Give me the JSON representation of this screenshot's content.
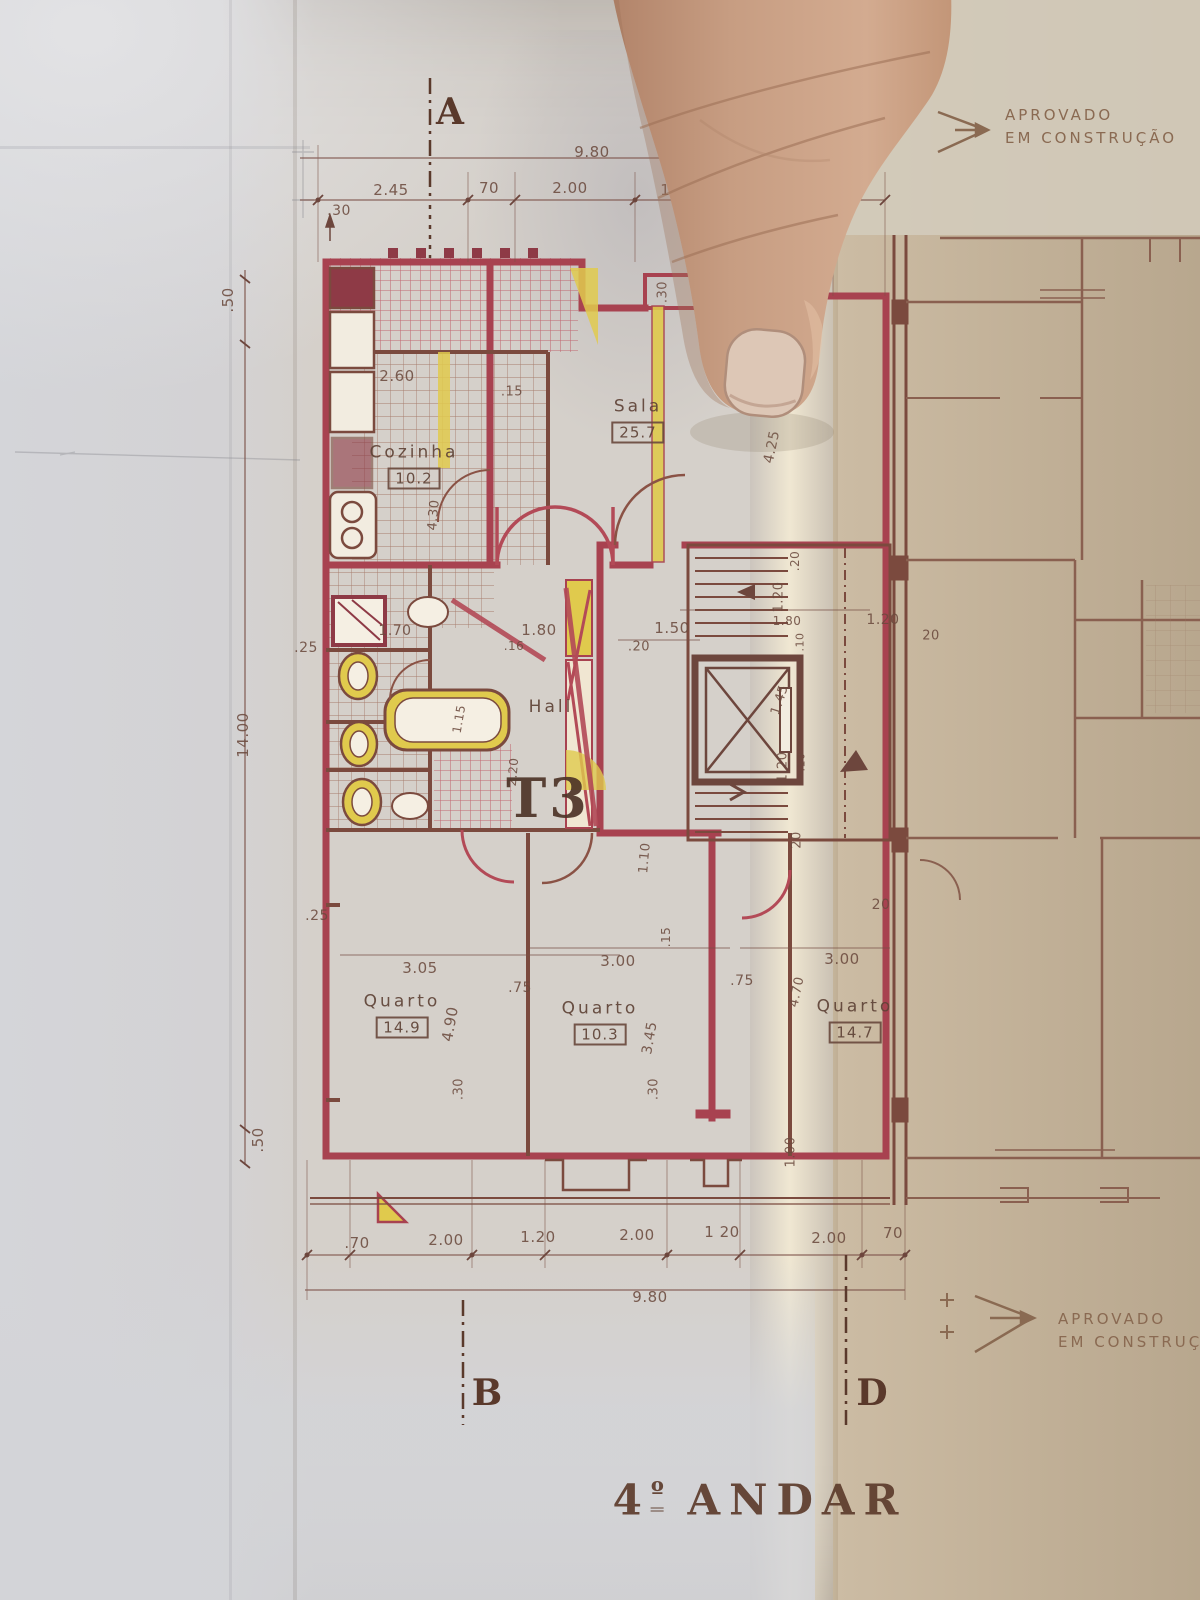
{
  "plan": {
    "floor_title": {
      "number": "4",
      "ordinal": "º",
      "word": "ANDAR"
    },
    "unit_type": "T3",
    "approval_top": {
      "line1": "APROVADO",
      "line2": "EM CONSTRUÇÃO"
    },
    "approval_bottom": {
      "line1": "APROVADO",
      "line2": "EM CONSTRUÇÃ"
    },
    "sections": {
      "a": "A",
      "b": "B",
      "d": "D"
    },
    "rooms": {
      "cozinha": {
        "name": "Cozinha",
        "area": "10.2"
      },
      "sala": {
        "name": "Sala",
        "area": "25.7"
      },
      "hall": {
        "name": "Hall"
      },
      "quarto1": {
        "name": "Quarto",
        "area": "14.9"
      },
      "quarto2": {
        "name": "Quarto",
        "area": "10.3"
      },
      "quarto3": {
        "name": "Quarto",
        "area": "14.7"
      }
    }
  },
  "dimension_labels": [
    {
      "t": "9.80",
      "x": 592,
      "y": 152
    },
    {
      "t": ".30",
      "x": 339,
      "y": 211,
      "fs": 14
    },
    {
      "t": "2.45",
      "x": 391,
      "y": 190
    },
    {
      "t": "70",
      "x": 489,
      "y": 188
    },
    {
      "t": "2.00",
      "x": 570,
      "y": 188
    },
    {
      "t": "1.50",
      "x": 678,
      "y": 190
    },
    {
      "t": "85",
      "x": 849,
      "y": 189
    },
    {
      "t": ".50",
      "x": 228,
      "y": 300,
      "r": -90
    },
    {
      "t": "14.00",
      "x": 243,
      "y": 735,
      "r": -90
    },
    {
      "t": ".25",
      "x": 306,
      "y": 648,
      "fs": 14
    },
    {
      "t": ".25",
      "x": 317,
      "y": 916,
      "fs": 14
    },
    {
      "t": ".50",
      "x": 258,
      "y": 1140,
      "r": -90
    },
    {
      "t": "2.60",
      "x": 397,
      "y": 376
    },
    {
      "t": ".15",
      "x": 512,
      "y": 392,
      "fs": 13
    },
    {
      "t": "6.6",
      "x": 716,
      "y": 370,
      "fs": 14
    },
    {
      "t": ".30",
      "x": 663,
      "y": 292,
      "r": -90,
      "fs": 13
    },
    {
      "t": "4.25",
      "x": 772,
      "y": 447,
      "r": -78,
      "fs": 14
    },
    {
      "t": "4.30",
      "x": 434,
      "y": 515,
      "r": -85,
      "fs": 13
    },
    {
      "t": "1.70",
      "x": 395,
      "y": 631,
      "fs": 14
    },
    {
      "t": "1.80",
      "x": 539,
      "y": 630
    },
    {
      "t": ".16",
      "x": 514,
      "y": 646,
      "fs": 12
    },
    {
      "t": "1.50",
      "x": 672,
      "y": 628
    },
    {
      "t": ".20",
      "x": 639,
      "y": 647,
      "fs": 13
    },
    {
      "t": "1.15",
      "x": 459,
      "y": 719,
      "r": -80,
      "fs": 12
    },
    {
      "t": "2.20",
      "x": 513,
      "y": 772,
      "r": -85,
      "fs": 12
    },
    {
      "t": "1.20",
      "x": 779,
      "y": 597,
      "r": -90,
      "fs": 13
    },
    {
      "t": "1.80",
      "x": 787,
      "y": 621,
      "fs": 12
    },
    {
      "t": "1.20",
      "x": 883,
      "y": 620,
      "fs": 14
    },
    {
      "t": "20",
      "x": 931,
      "y": 636,
      "fs": 13
    },
    {
      "t": "1.45",
      "x": 780,
      "y": 700,
      "r": -72,
      "fs": 13
    },
    {
      "t": ".10",
      "x": 800,
      "y": 642,
      "r": -90,
      "fs": 11
    },
    {
      "t": "1.20",
      "x": 783,
      "y": 767,
      "r": -90,
      "fs": 13
    },
    {
      "t": ".10",
      "x": 801,
      "y": 762,
      "r": -90,
      "fs": 11
    },
    {
      "t": ".20",
      "x": 795,
      "y": 561,
      "r": -90,
      "fs": 12
    },
    {
      "t": "20",
      "x": 797,
      "y": 840,
      "r": -90,
      "fs": 13
    },
    {
      "t": "1.10",
      "x": 645,
      "y": 858,
      "r": -85,
      "fs": 13
    },
    {
      "t": ".15",
      "x": 666,
      "y": 937,
      "r": -90,
      "fs": 12
    },
    {
      "t": "3.05",
      "x": 420,
      "y": 968
    },
    {
      "t": ".75",
      "x": 520,
      "y": 988,
      "fs": 14
    },
    {
      "t": "3.00",
      "x": 618,
      "y": 961
    },
    {
      "t": ".75",
      "x": 742,
      "y": 981,
      "fs": 14
    },
    {
      "t": "4.70",
      "x": 797,
      "y": 992,
      "r": -78,
      "fs": 13
    },
    {
      "t": "3.00",
      "x": 842,
      "y": 959
    },
    {
      "t": "4.90",
      "x": 450,
      "y": 1024,
      "r": -80
    },
    {
      "t": "3.45",
      "x": 650,
      "y": 1038,
      "r": -80,
      "fs": 14
    },
    {
      "t": ".30",
      "x": 459,
      "y": 1089,
      "r": -90,
      "fs": 13
    },
    {
      "t": ".30",
      "x": 654,
      "y": 1089,
      "r": -90,
      "fs": 13
    },
    {
      "t": "1.00",
      "x": 791,
      "y": 1152,
      "r": -90,
      "fs": 13
    },
    {
      "t": "20",
      "x": 881,
      "y": 905,
      "fs": 14
    },
    {
      "t": ".70",
      "x": 357,
      "y": 1243
    },
    {
      "t": "2.00",
      "x": 446,
      "y": 1240
    },
    {
      "t": "1.20",
      "x": 538,
      "y": 1237
    },
    {
      "t": "2.00",
      "x": 637,
      "y": 1235
    },
    {
      "t": "1 20",
      "x": 722,
      "y": 1232
    },
    {
      "t": "2.00",
      "x": 829,
      "y": 1238
    },
    {
      "t": "70",
      "x": 893,
      "y": 1233
    },
    {
      "t": "9.80",
      "x": 650,
      "y": 1297
    }
  ]
}
